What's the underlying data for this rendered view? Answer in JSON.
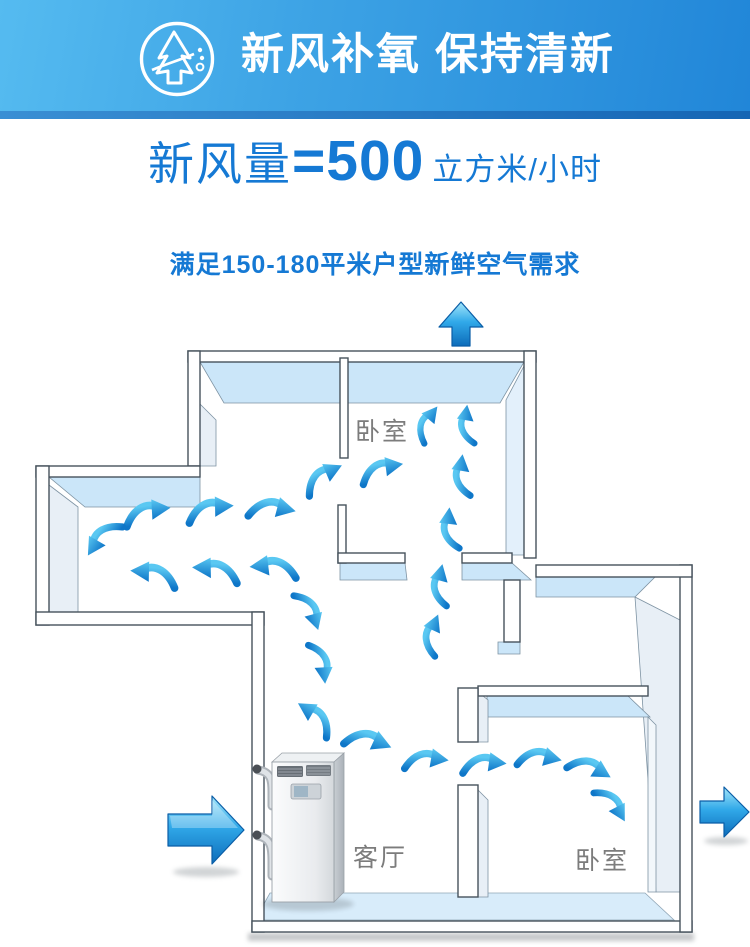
{
  "banner": {
    "title": "新风补氧 保持清新",
    "icon": "pine-tree-fresh-air-icon",
    "bg_left": "#55bbf0",
    "bg_right": "#2186d8"
  },
  "headline": {
    "label": "新风量",
    "equals": "=",
    "value": "500",
    "unit": "立方米/小时",
    "color": "#1579d4"
  },
  "subline": {
    "text": "满足150-180平米户型新鲜空气需求"
  },
  "floorplan": {
    "rooms": [
      {
        "label": "卧室"
      },
      {
        "label": "客厅"
      },
      {
        "label": "卧室"
      }
    ],
    "colors": {
      "wall_stroke": "#46525c",
      "wall_cap_blue": "#cbe6f9",
      "wall_face_gray": "#e8eff6",
      "floor_blue": "#d8ecfa",
      "airflow_blue": "#1e90d8",
      "label_gray": "#7c7c7c"
    }
  }
}
